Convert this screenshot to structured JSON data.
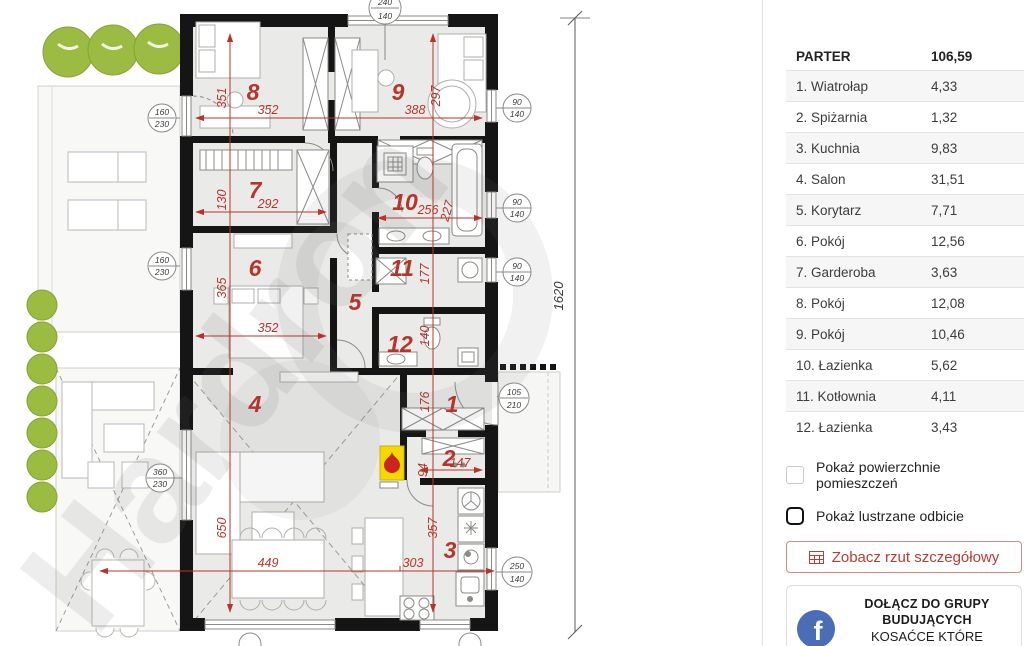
{
  "panel": {
    "rooms_table": {
      "header_label": "PARTER",
      "header_value": "106,59",
      "rows": [
        {
          "label": "1. Wiatrołap",
          "value": "4,33"
        },
        {
          "label": "2. Spiżarnia",
          "value": "1,32"
        },
        {
          "label": "3. Kuchnia",
          "value": "9,83"
        },
        {
          "label": "4. Salon",
          "value": "31,51"
        },
        {
          "label": "5. Korytarz",
          "value": "7,71"
        },
        {
          "label": "6. Pokój",
          "value": "12,56"
        },
        {
          "label": "7. Garderoba",
          "value": "3,63"
        },
        {
          "label": "8. Pokój",
          "value": "12,08"
        },
        {
          "label": "9. Pokój",
          "value": "10,46"
        },
        {
          "label": "10. Łazienka",
          "value": "5,62"
        },
        {
          "label": "11. Kotłownia",
          "value": "4,11"
        },
        {
          "label": "12. Łazienka",
          "value": "3,43"
        }
      ]
    },
    "show_areas_label": "Pokaż powierzchnie pomieszczeń",
    "show_mirror_label": "Pokaż lustrzane odbicie",
    "detail_button_label": "Zobacz rzut szczegółowy",
    "facebook_card": {
      "line1": "DOŁĄCZ DO GRUPY",
      "line2": "BUDUJĄCYCH",
      "line3": "KOSAĆCE KTÓRE KOCHACIE"
    }
  },
  "plan": {
    "watermark": "Hardron",
    "overall_height_dim": "1620",
    "rooms": {
      "r1": {
        "num": "1",
        "h": "176"
      },
      "r2": {
        "num": "2",
        "w": "147",
        "h": "94"
      },
      "r3": {
        "num": "3",
        "w": "303",
        "h": "357"
      },
      "r4": {
        "num": "4",
        "w": "449",
        "h": "650"
      },
      "r5": {
        "num": "5"
      },
      "r6": {
        "num": "6",
        "w": "352",
        "h": "365"
      },
      "r7": {
        "num": "7",
        "w": "292",
        "h": "130"
      },
      "r8": {
        "num": "8",
        "w": "352",
        "h": "351"
      },
      "r9": {
        "num": "9",
        "w": "388",
        "h": "297"
      },
      "r10": {
        "num": "10",
        "w": "256",
        "h": "227"
      },
      "r11": {
        "num": "11",
        "h": "177"
      },
      "r12": {
        "num": "12",
        "h": "140"
      }
    },
    "markers": {
      "top": {
        "a": "240",
        "b": "140"
      },
      "left1": {
        "a": "160",
        "b": "230"
      },
      "left2": {
        "a": "160",
        "b": "230"
      },
      "left3": {
        "a": "360",
        "b": "230"
      },
      "right1": {
        "a": "90",
        "b": "140"
      },
      "right2": {
        "a": "90",
        "b": "140"
      },
      "right3": {
        "a": "90",
        "b": "140"
      },
      "entry": {
        "a": "105",
        "b": "210"
      },
      "kitchen": {
        "a": "250",
        "b": "140"
      }
    }
  },
  "colors": {
    "annotation_red": "#b5352c",
    "accent_button_red": "#bf3a30",
    "facebook_blue": "#4a6db5",
    "vegetation_green": "#9cbb42",
    "wall_black": "#151515",
    "room_fill": "#eaeae8"
  }
}
